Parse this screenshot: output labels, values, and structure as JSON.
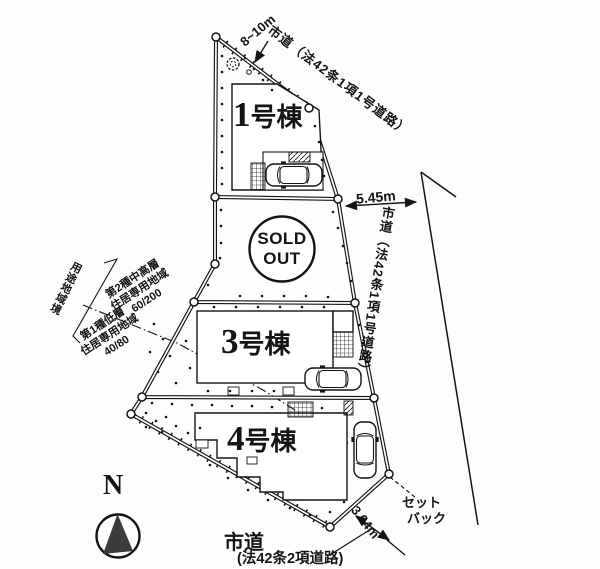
{
  "plots": {
    "plot1": {
      "num": "1",
      "suffix": "号棟"
    },
    "plot2": {
      "status_line1": "SOLD",
      "status_line2": "OUT"
    },
    "plot3": {
      "num": "3",
      "suffix": "号棟"
    },
    "plot4": {
      "num": "4",
      "suffix": "号棟"
    }
  },
  "roads": {
    "north": {
      "label": "市道（法42条1項1号道路）",
      "width": "8~10m"
    },
    "east": {
      "label": "市道（法42条1項1号道路）",
      "distance": "5.45m"
    },
    "south": {
      "label": "市道",
      "sublabel": "(法42条2項道路)",
      "width": "3.64m"
    },
    "setback": {
      "line1": "セット",
      "line2": "バック"
    }
  },
  "zoning": {
    "boundary_label": "用途地域境",
    "zone_north": {
      "line1": "第2種中高層",
      "line2": "住居専用地域",
      "ratio": "60/200"
    },
    "zone_south": {
      "line1": "第1種低層",
      "line2": "住居専用地域",
      "ratio": "40/80"
    }
  },
  "compass": {
    "north_label": "N"
  },
  "colors": {
    "line": "#141414",
    "background": "#fdfdfd"
  }
}
